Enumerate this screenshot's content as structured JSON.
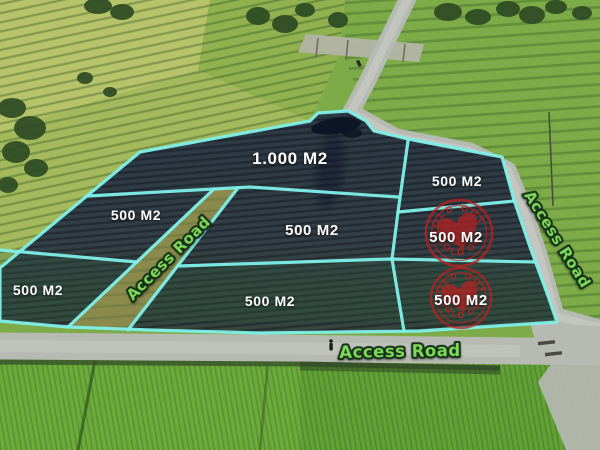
{
  "plots": [
    {
      "id": "plot-1000m2",
      "label": "1.000 M2",
      "sold": false
    },
    {
      "id": "plot-top-right-500m2",
      "label": "500 M2",
      "sold": false
    },
    {
      "id": "plot-upper-left-500m2",
      "label": "500 M2",
      "sold": false
    },
    {
      "id": "plot-center-500m2",
      "label": "500 M2",
      "sold": false
    },
    {
      "id": "plot-right-mid-500m2",
      "label": "500 M2",
      "sold": true
    },
    {
      "id": "plot-left-500m2",
      "label": "500 M2",
      "sold": false
    },
    {
      "id": "plot-bottom-500m2",
      "label": "500 M2",
      "sold": false
    },
    {
      "id": "plot-right-bot-500m2",
      "label": "500 M2",
      "sold": true
    }
  ],
  "road_labels": [
    {
      "id": "access-road-diagonal",
      "text": "Access Road"
    },
    {
      "id": "access-road-east",
      "text": "Access Road"
    },
    {
      "id": "access-road-south",
      "text": "Access Road"
    }
  ],
  "stamps": [
    {
      "id": "sold-stamp-upper",
      "arc_top": "SOLD OUT",
      "arc_bottom": "SOLD OUT"
    },
    {
      "id": "sold-stamp-lower",
      "arc_top": "SOLD OUT",
      "arc_bottom": "SOLD OUT"
    }
  ],
  "colors": {
    "plot_outline": "#7ff0ea",
    "plot_label_text": "#ffffff",
    "road_label_text": "#7ed957",
    "road_label_outline": "#16301a",
    "stamp_red": "#c1201f",
    "plot_fill_dark": "#2e3a44",
    "field_green": "#8fb04e",
    "road_gray": "#b6bab3"
  }
}
